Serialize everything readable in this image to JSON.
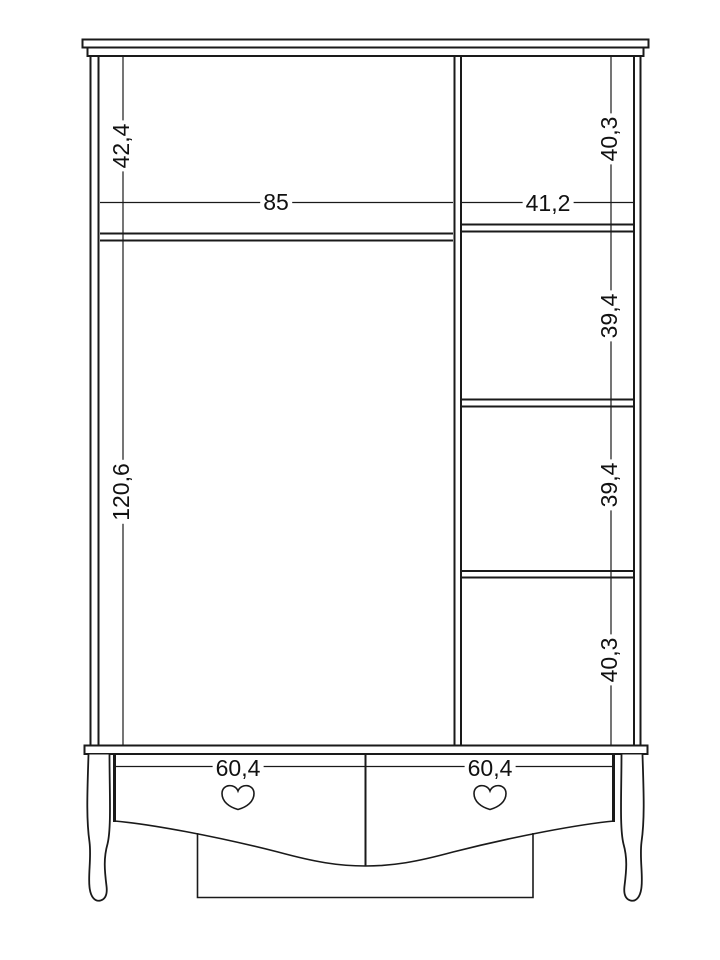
{
  "drawing": {
    "type": "furniture-technical-drawing",
    "subject": "wardrobe-front-elevation",
    "colors": {
      "background": "#ffffff",
      "line": "#1a1a1a",
      "text": "#111111"
    },
    "dimensions": {
      "left_upper_height": "42,4",
      "left_width": "85",
      "left_lower_height": "120,6",
      "right_width": "41,2",
      "right_top_height": "40,3",
      "right_upper_mid_height": "39,4",
      "right_lower_mid_height": "39,4",
      "right_bottom_height": "40,3",
      "left_drawer_width": "60,4",
      "right_drawer_width": "60,4"
    }
  }
}
